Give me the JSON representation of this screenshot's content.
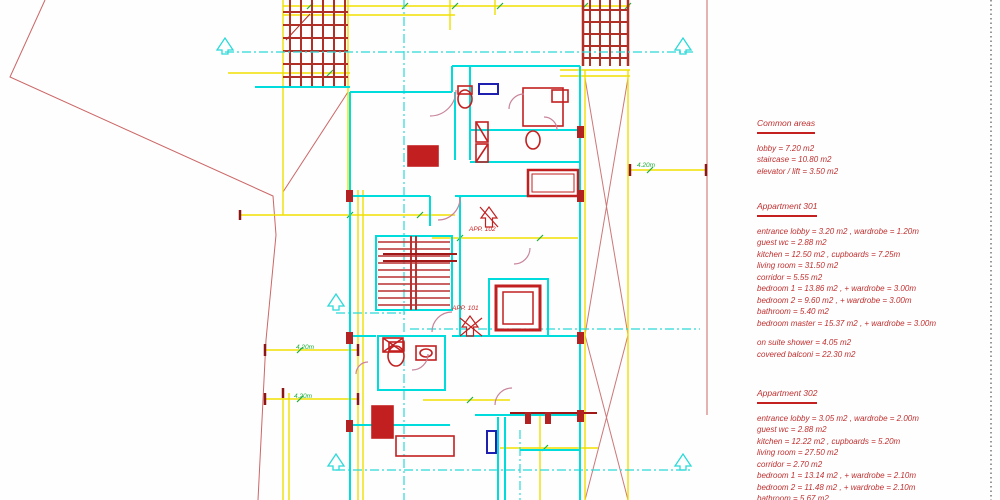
{
  "palette": {
    "wall_cyan": "#00dcdc",
    "centerline_cyan": "#2bd9d9",
    "fixture_red": "#c22020",
    "partition_dark_red": "#a01818",
    "pergola_red": "#b03028",
    "dimension_yellow": "#f0e000",
    "dim_text_green": "#1fae3c",
    "door_swing_pink": "#c8849a",
    "site_boundary_pink": "#cc6666",
    "window_blue": "#2020b0",
    "legend_red": "#c03030"
  },
  "plan": {
    "labels": [
      {
        "text": "APP. 102"
      },
      {
        "text": "APP. 101"
      }
    ],
    "dimensions": [
      {
        "text": "4.20m"
      },
      {
        "text": "4.20m"
      },
      {
        "text": "4.20m"
      }
    ]
  },
  "legend": {
    "sections": [
      {
        "title": "Common areas",
        "lines": [
          "lobby = 7.20 m2",
          "staircase = 10.80 m2",
          "elevator / lift = 3.50 m2"
        ]
      },
      {
        "title": "Appartment 301",
        "lines": [
          "entrance lobby = 3.20 m2 , wardrobe = 1.20m",
          "guest wc = 2.88 m2",
          "kitchen = 12.50 m2 , cupboards = 7.25m",
          "living room = 31.50 m2",
          "corridor = 5.55 m2",
          "bedroom 1 = 13.86 m2 , + wardrobe = 3.00m",
          "bedroom 2 = 9.60 m2 , + wardrobe = 3.00m",
          "bathroom = 5.40 m2",
          "bedroom master = 15.37 m2 , + wardrobe = 3.00m",
          "on suite shower = 4.05 m2",
          "covered balconi = 22.30 m2"
        ]
      },
      {
        "title": "Appartment 302",
        "lines": [
          "entrance lobby = 3.05 m2 , wardrobe = 2.00m",
          "guest wc = 2.88 m2",
          "kitchen = 12.22 m2 , cupboards = 5.20m",
          "living room = 27.50 m2",
          "corridor = 2.70 m2",
          "bedroom 1 = 13.14 m2 , + wardrobe = 2.10m",
          "bedroom 2 = 11.48 m2 , + wardrobe = 2.10m",
          "bathroom = 5.67 m2"
        ]
      }
    ]
  }
}
